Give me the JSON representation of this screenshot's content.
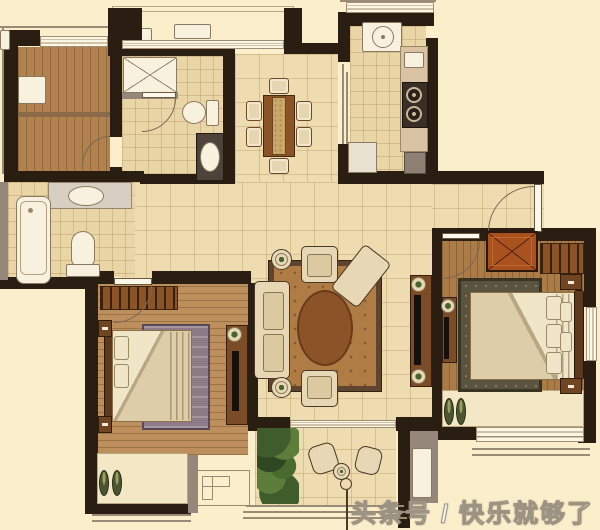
{
  "watermark": {
    "text": "头条号 / 快乐就够了"
  },
  "annotation": {
    "marker": "circle-with-leader-line"
  },
  "palette": {
    "background": "#fbeecb",
    "wall": "#2a1d12",
    "wall_gray": "#95887a",
    "tile": "#eedcb0",
    "tile_small": "#ead5a6",
    "wood": "#b2824e",
    "wood_master": "#bd8f5c",
    "fixture_white": "#f8f1de",
    "counter_tan": "#d9c3a2",
    "stove_dark": "#3a2f26",
    "rug_living_field": "#b07c46",
    "rug_living_oval": "#8d5328",
    "rug_master": "#8d7b88",
    "rug_bedroom2": "#5a5340",
    "sofa_cream": "#e7d7b5",
    "console_brown": "#7b4c26",
    "wardrobe_orange": "#aa5120",
    "plant_green": "#47632e",
    "bench_light": "#f3e7c6",
    "annotation_line": "#4a3a28"
  },
  "rooms": [
    {
      "id": "study",
      "floor": "wood",
      "furniture": [
        "desk"
      ]
    },
    {
      "id": "main-bathroom",
      "floor": "tile",
      "furniture": [
        "shower",
        "toilet",
        "wash-basin"
      ]
    },
    {
      "id": "second-bathroom",
      "floor": "tile",
      "furniture": [
        "bathtub",
        "vanity-basin",
        "toilet"
      ]
    },
    {
      "id": "kitchen",
      "floor": "tile",
      "furniture": [
        "kitchen-sink",
        "two-burner-stove",
        "counter",
        "fridge"
      ]
    },
    {
      "id": "dining-room",
      "floor": "tile",
      "furniture": [
        "dining-table",
        "six-chairs"
      ]
    },
    {
      "id": "entry-hall",
      "floor": "tile",
      "furniture": [
        "entry-door"
      ]
    },
    {
      "id": "living-room",
      "floor": "tile",
      "furniture": [
        "sofa",
        "two-armchairs",
        "chaise",
        "area-rug",
        "two-side-tables",
        "tv-console"
      ]
    },
    {
      "id": "master-bedroom",
      "floor": "wood",
      "furniture": [
        "double-bed",
        "wardrobe",
        "rug",
        "two-nightstands",
        "tv-console",
        "slippers",
        "bay-window-bench"
      ]
    },
    {
      "id": "second-bedroom",
      "floor": "wood",
      "furniture": [
        "double-bed",
        "wardrobe",
        "closet-rack",
        "two-nightstands",
        "tv-console",
        "slippers",
        "bay-window-bench"
      ]
    },
    {
      "id": "balcony",
      "floor": "tile",
      "furniture": [
        "two-chairs",
        "round-table",
        "plants"
      ]
    },
    {
      "id": "equipment-platform",
      "floor": "none",
      "furniture": [
        "ac-outdoor-unit"
      ]
    }
  ]
}
